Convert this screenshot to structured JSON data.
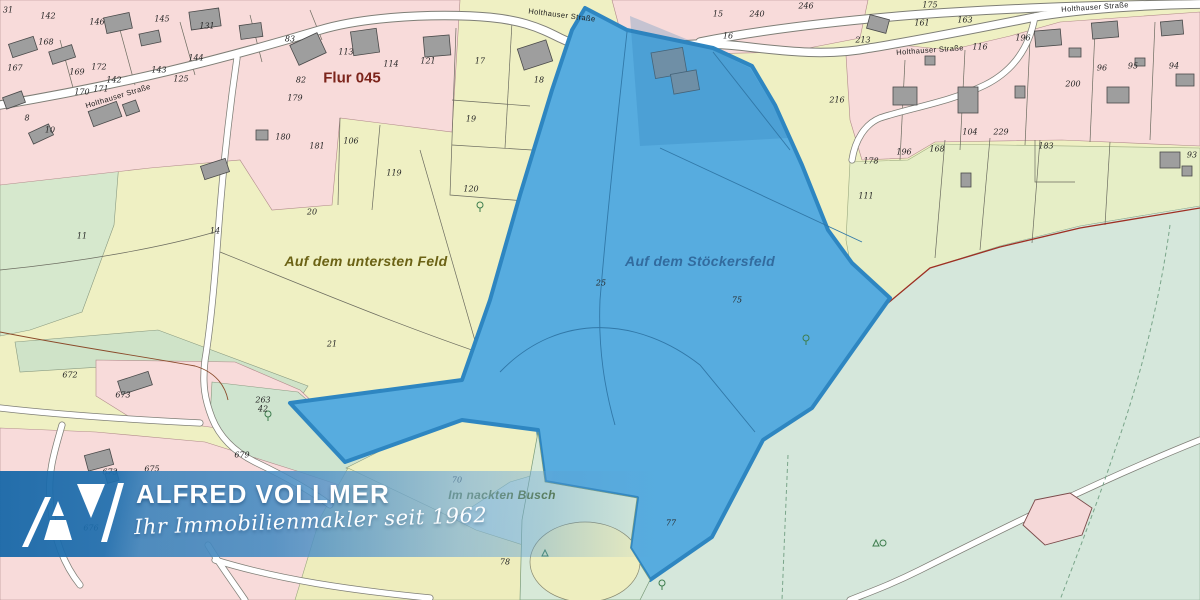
{
  "theme": {
    "field_yellow": "#eff0c3",
    "residential_pink": "#f8dbda",
    "meadow_green": "#d6e8cd",
    "forest_teal": "#d5e7db",
    "strip_green": "#e6eec6",
    "parcel_blue": "#57acdf",
    "parcel_blue_border": "#2e86c1",
    "building_gray": "#9e9e9e",
    "road_white": "#ffffff",
    "boundary_red": "#9e2f23",
    "banner_blue": "#1868a8"
  },
  "map": {
    "streets": [
      {
        "label": "Holthauser Straße",
        "x": 118,
        "y": 96,
        "rot": -17
      },
      {
        "label": "Holthauser Straße",
        "x": 562,
        "y": 15,
        "rot": 7
      },
      {
        "label": "Holthauser Straße",
        "x": 930,
        "y": 50,
        "rot": -4
      },
      {
        "label": "Holthauser Straße",
        "x": 1095,
        "y": 7,
        "rot": -4
      }
    ],
    "area_labels": [
      {
        "label": "Flur 045",
        "x": 352,
        "y": 78,
        "style": "flur"
      },
      {
        "label": "Auf dem untersten Feld",
        "x": 366,
        "y": 261,
        "style": "field-yellow"
      },
      {
        "label": "Auf dem Stöckersfeld",
        "x": 700,
        "y": 261,
        "style": "field-blue"
      },
      {
        "label": "Im nackten Busch",
        "x": 502,
        "y": 495,
        "style": "field-green"
      }
    ],
    "parcel_numbers": [
      {
        "label": "31",
        "x": 8,
        "y": 10
      },
      {
        "label": "142",
        "x": 48,
        "y": 16
      },
      {
        "label": "146",
        "x": 97,
        "y": 22
      },
      {
        "label": "145",
        "x": 162,
        "y": 19
      },
      {
        "label": "131",
        "x": 207,
        "y": 26
      },
      {
        "label": "83",
        "x": 290,
        "y": 39
      },
      {
        "label": "168",
        "x": 46,
        "y": 42
      },
      {
        "label": "167",
        "x": 15,
        "y": 68
      },
      {
        "label": "169",
        "x": 77,
        "y": 72
      },
      {
        "label": "172",
        "x": 99,
        "y": 67
      },
      {
        "label": "142",
        "x": 114,
        "y": 80
      },
      {
        "label": "143",
        "x": 159,
        "y": 70
      },
      {
        "label": "144",
        "x": 196,
        "y": 58
      },
      {
        "label": "170",
        "x": 82,
        "y": 92
      },
      {
        "label": "171",
        "x": 101,
        "y": 89
      },
      {
        "label": "125",
        "x": 181,
        "y": 79
      },
      {
        "label": "8",
        "x": 27,
        "y": 118
      },
      {
        "label": "10",
        "x": 50,
        "y": 130
      },
      {
        "label": "113",
        "x": 346,
        "y": 52
      },
      {
        "label": "114",
        "x": 391,
        "y": 64
      },
      {
        "label": "121",
        "x": 428,
        "y": 61
      },
      {
        "label": "17",
        "x": 480,
        "y": 61
      },
      {
        "label": "18",
        "x": 539,
        "y": 80
      },
      {
        "label": "19",
        "x": 471,
        "y": 119
      },
      {
        "label": "82",
        "x": 301,
        "y": 80
      },
      {
        "label": "179",
        "x": 295,
        "y": 98
      },
      {
        "label": "180",
        "x": 283,
        "y": 137
      },
      {
        "label": "181",
        "x": 317,
        "y": 146
      },
      {
        "label": "106",
        "x": 351,
        "y": 141
      },
      {
        "label": "119",
        "x": 394,
        "y": 173
      },
      {
        "label": "120",
        "x": 471,
        "y": 189
      },
      {
        "label": "15",
        "x": 718,
        "y": 14
      },
      {
        "label": "240",
        "x": 757,
        "y": 14
      },
      {
        "label": "246",
        "x": 806,
        "y": 6
      },
      {
        "label": "16",
        "x": 728,
        "y": 36
      },
      {
        "label": "213",
        "x": 863,
        "y": 40
      },
      {
        "label": "216",
        "x": 837,
        "y": 100
      },
      {
        "label": "178",
        "x": 871,
        "y": 161
      },
      {
        "label": "111",
        "x": 866,
        "y": 196
      },
      {
        "label": "175",
        "x": 930,
        "y": 5
      },
      {
        "label": "161",
        "x": 922,
        "y": 23
      },
      {
        "label": "163",
        "x": 965,
        "y": 20
      },
      {
        "label": "196",
        "x": 1023,
        "y": 38
      },
      {
        "label": "116",
        "x": 980,
        "y": 47
      },
      {
        "label": "200",
        "x": 1073,
        "y": 84
      },
      {
        "label": "96",
        "x": 1102,
        "y": 68
      },
      {
        "label": "95",
        "x": 1133,
        "y": 66
      },
      {
        "label": "94",
        "x": 1174,
        "y": 66
      },
      {
        "label": "104",
        "x": 970,
        "y": 132
      },
      {
        "label": "229",
        "x": 1001,
        "y": 132
      },
      {
        "label": "183",
        "x": 1046,
        "y": 146
      },
      {
        "label": "196",
        "x": 904,
        "y": 152
      },
      {
        "label": "168",
        "x": 937,
        "y": 149
      },
      {
        "label": "93",
        "x": 1192,
        "y": 155
      },
      {
        "label": "20",
        "x": 312,
        "y": 212
      },
      {
        "label": "14",
        "x": 215,
        "y": 231
      },
      {
        "label": "11",
        "x": 82,
        "y": 236
      },
      {
        "label": "21",
        "x": 332,
        "y": 344
      },
      {
        "label": "25",
        "x": 601,
        "y": 283
      },
      {
        "label": "75",
        "x": 737,
        "y": 300
      },
      {
        "label": "672",
        "x": 70,
        "y": 375
      },
      {
        "label": "673",
        "x": 123,
        "y": 395
      },
      {
        "label": "263",
        "x": 263,
        "y": 400
      },
      {
        "label": "42",
        "x": 263,
        "y": 409
      },
      {
        "label": "679",
        "x": 242,
        "y": 455
      },
      {
        "label": "673",
        "x": 110,
        "y": 472
      },
      {
        "label": "675",
        "x": 152,
        "y": 469
      },
      {
        "label": "676",
        "x": 91,
        "y": 528
      },
      {
        "label": "70",
        "x": 457,
        "y": 480
      },
      {
        "label": "78",
        "x": 505,
        "y": 562
      },
      {
        "label": "77",
        "x": 671,
        "y": 523
      }
    ]
  },
  "banner": {
    "brand": "ALFRED VOLLMER",
    "tagline": "Ihr Immobilienmakler seit 1962"
  }
}
